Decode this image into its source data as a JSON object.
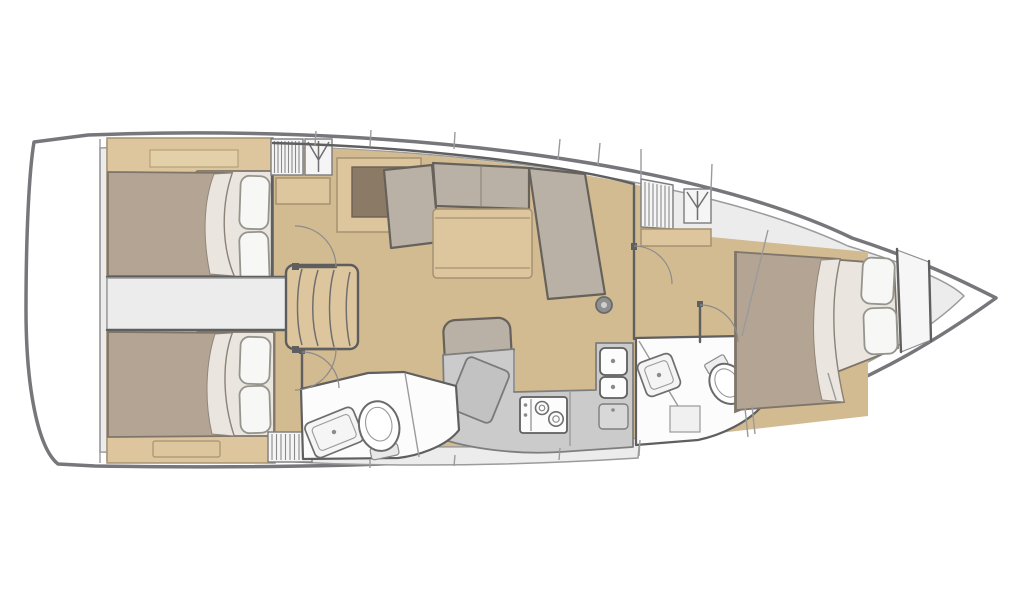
{
  "meta": {
    "kind": "floor-plan",
    "subject": "sailing-yacht-interior",
    "view": "overhead",
    "text_visible": false
  },
  "colors": {
    "hull_stroke": "#77777b",
    "deck": "#ececec",
    "deck_line": "#9b9b9b",
    "line": "#5f5f5f",
    "floor": "#d2ba91",
    "wood": "#ddc69d",
    "wood_dark": "#a59272",
    "bed": "#b3a494",
    "bed_line": "#7f756a",
    "sheet": "#eae6df",
    "sheet_line": "#8f867c",
    "pillow": "#f7f7f5",
    "pillow_line": "#95958d",
    "cushion": "#b9b1a5",
    "cushion_line": "#66625b",
    "counter": "#cbcbcb",
    "counter_line": "#7e7e7e",
    "fixture": "#fcfcfc",
    "inset": "#8b7b66",
    "locker": "#f5f5f5"
  },
  "areas": [
    {
      "id": "swim-platform"
    },
    {
      "id": "aft-cabin-port"
    },
    {
      "id": "aft-cabin-starboard"
    },
    {
      "id": "companionway-steps"
    },
    {
      "id": "salon"
    },
    {
      "id": "nav-station"
    },
    {
      "id": "galley"
    },
    {
      "id": "aft-head"
    },
    {
      "id": "forward-head"
    },
    {
      "id": "forward-cabin"
    },
    {
      "id": "anchor-locker"
    }
  ],
  "icons": [
    {
      "name": "wardrobe-icon",
      "meaning": "hanging locker symbol"
    },
    {
      "name": "louver-locker",
      "meaning": "ventilated locker / shelving"
    },
    {
      "name": "mast-post",
      "meaning": "mast compression post"
    }
  ]
}
